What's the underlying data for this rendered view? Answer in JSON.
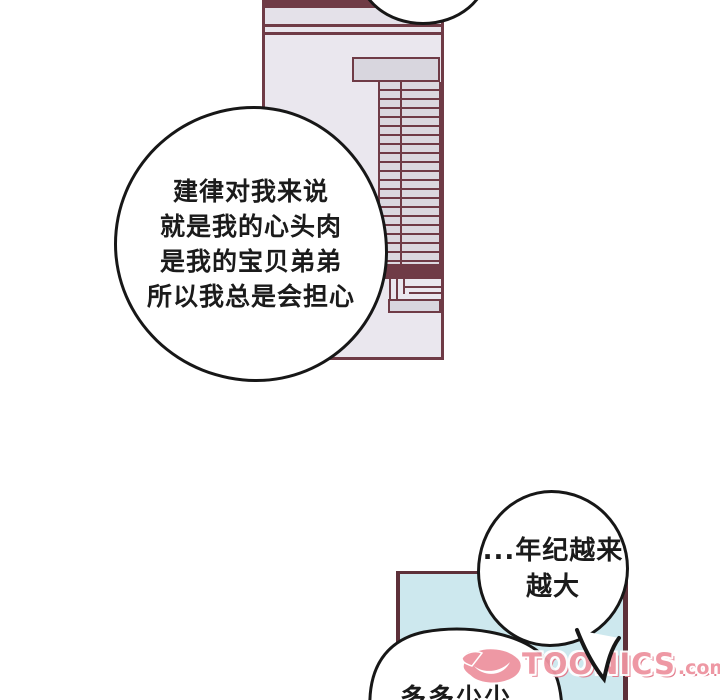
{
  "page": {
    "kind": "webtoon-comic-page",
    "background": "#ffffff"
  },
  "colors": {
    "panel_line_maroon": "#6f3b46",
    "panel_border_dark": "#5d3039",
    "wall_lavender": "#eae7ee",
    "blind_slat_gray": "#d8d6de",
    "bottom_panel_blue": "#cde8ee",
    "outline_black": "#171717",
    "watermark_pink": "#ee93a0"
  },
  "speech_bubbles": {
    "main": {
      "lines": [
        "建律对我来说",
        "就是我的心头肉",
        "是我的宝贝弟弟",
        "所以我总是会担心"
      ]
    },
    "age": {
      "lines": [
        "...年纪越来",
        "越大"
      ]
    },
    "bottom": {
      "lines": [
        "多多少少"
      ]
    }
  },
  "watermark": {
    "logo": "stylized-d-logo",
    "brand": "TOONICS",
    "suffix": ".com"
  }
}
